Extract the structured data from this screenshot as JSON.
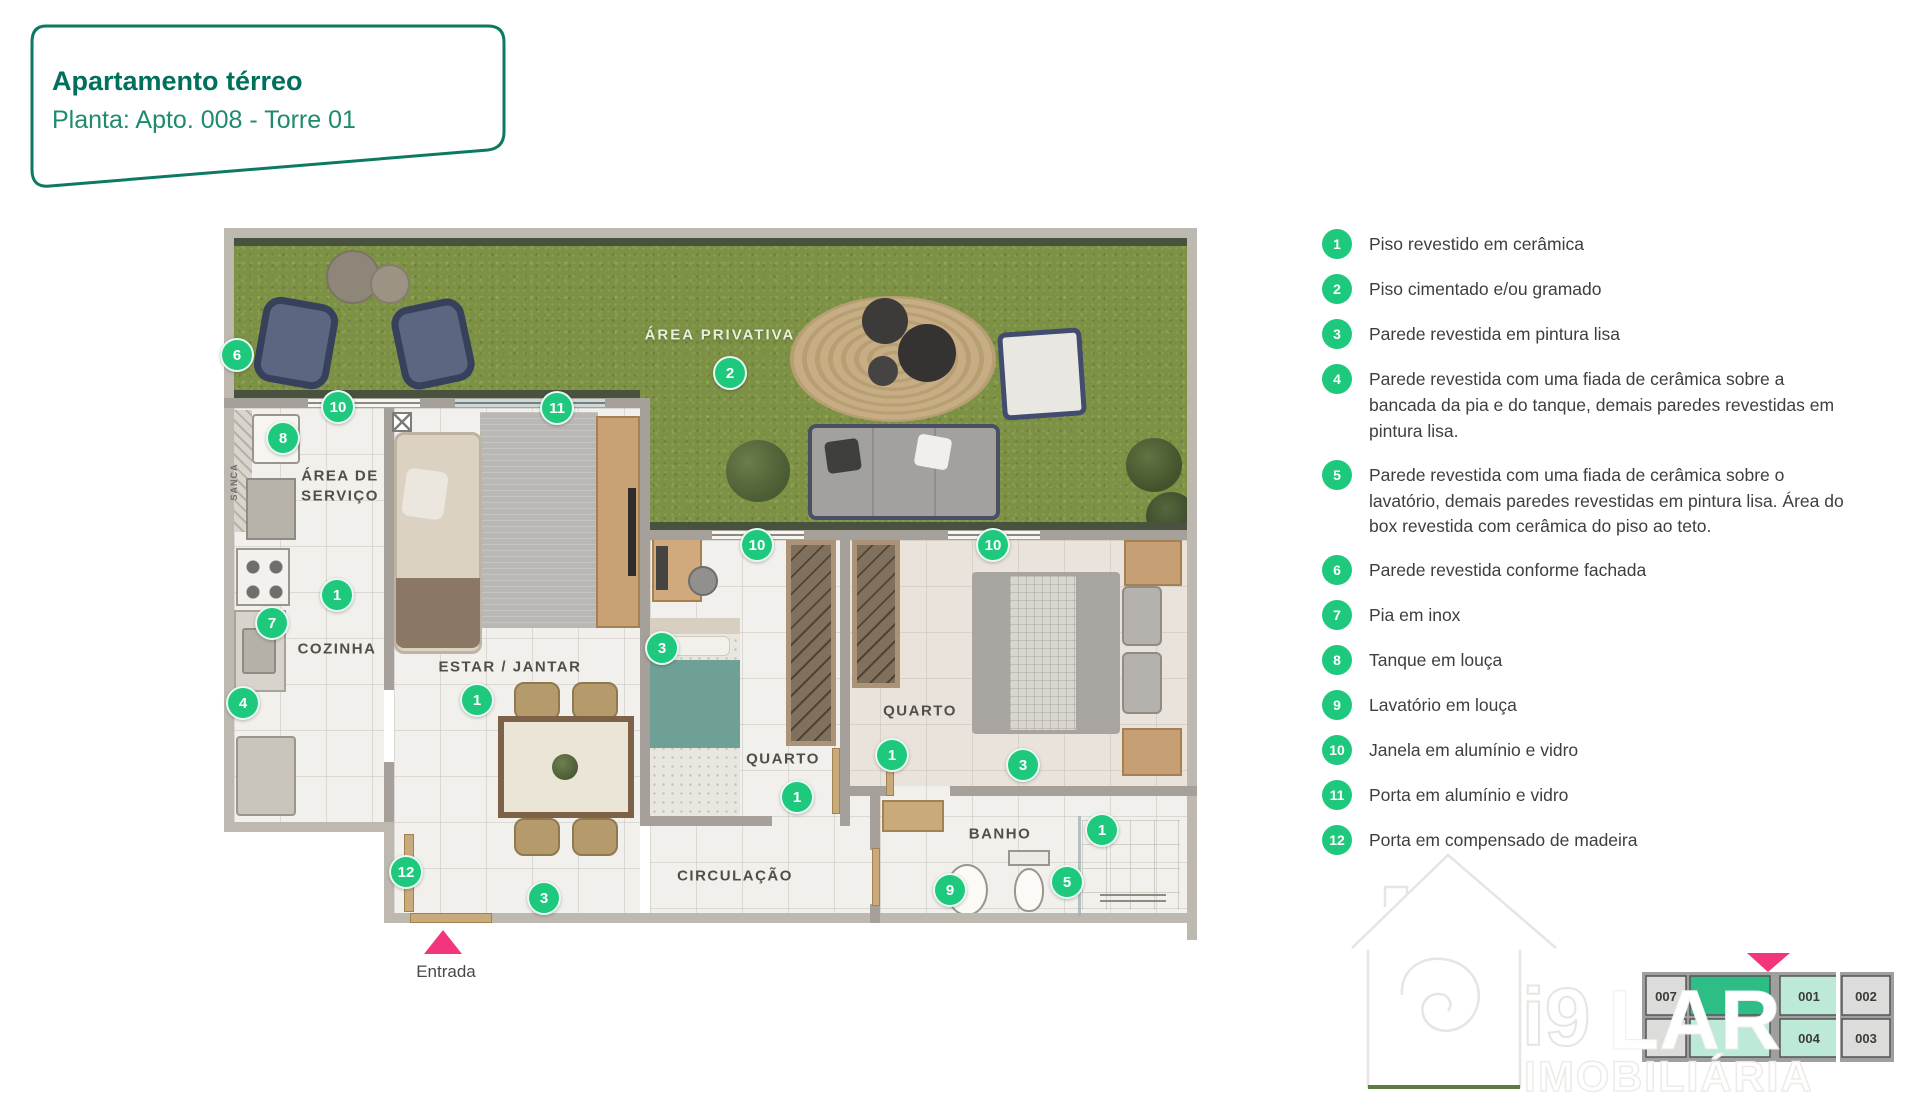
{
  "title": {
    "heading": "Apartamento térreo",
    "subheading": "Planta: Apto. 008 - Torre 01"
  },
  "plan": {
    "labels": {
      "area_privativa": "ÁREA PRIVATIVA",
      "area_servico_l1": "ÁREA DE",
      "area_servico_l2": "SERVIÇO",
      "cozinha": "COZINHA",
      "estar_jantar": "ESTAR / JANTAR",
      "quarto_1": "QUARTO",
      "quarto_2": "QUARTO",
      "banho": "BANHO",
      "circulacao": "CIRCULAÇÃO",
      "sanca": "SANCA",
      "entrada": "Entrada"
    },
    "markers": [
      {
        "n": "6"
      },
      {
        "n": "10"
      },
      {
        "n": "8"
      },
      {
        "n": "11"
      },
      {
        "n": "2"
      },
      {
        "n": "10"
      },
      {
        "n": "10"
      },
      {
        "n": "1"
      },
      {
        "n": "7"
      },
      {
        "n": "4"
      },
      {
        "n": "1"
      },
      {
        "n": "3"
      },
      {
        "n": "1"
      },
      {
        "n": "1"
      },
      {
        "n": "3"
      },
      {
        "n": "12"
      },
      {
        "n": "3"
      },
      {
        "n": "9"
      },
      {
        "n": "5"
      },
      {
        "n": "1"
      }
    ]
  },
  "legend": {
    "items": [
      {
        "num": "1",
        "text": "Piso revestido em cerâmica"
      },
      {
        "num": "2",
        "text": "Piso cimentado e/ou gramado"
      },
      {
        "num": "3",
        "text": "Parede revestida em pintura lisa"
      },
      {
        "num": "4",
        "text": "Parede revestida com uma fiada de cerâmica sobre a bancada da pia e do tanque, demais paredes revestidas em pintura lisa."
      },
      {
        "num": "5",
        "text": "Parede revestida com uma fiada de cerâmica sobre o lavatório, demais paredes revestidas em pintura lisa. Área do box revestida com cerâmica do piso ao teto."
      },
      {
        "num": "6",
        "text": "Parede revestida conforme fachada"
      },
      {
        "num": "7",
        "text": "Pia em inox"
      },
      {
        "num": "8",
        "text": "Tanque em louça"
      },
      {
        "num": "9",
        "text": "Lavatório em louça"
      },
      {
        "num": "10",
        "text": "Janela em alumínio e vidro"
      },
      {
        "num": "11",
        "text": "Porta em alumínio e vidro"
      },
      {
        "num": "12",
        "text": "Porta em compensado de madeira"
      }
    ]
  },
  "brand": {
    "i9": "i9",
    "lar": "LAR",
    "imobiliaria": "IMOBILIÁRIA",
    "keyplan": {
      "units": [
        {
          "label": "007"
        },
        {
          "label": ""
        },
        {
          "label": "001"
        },
        {
          "label": "002"
        },
        {
          "label": ""
        },
        {
          "label": ""
        },
        {
          "label": "004"
        },
        {
          "label": "003"
        }
      ]
    }
  },
  "colors": {
    "marker_green": "#1ec97e",
    "title_teal": "#00705c",
    "subtitle_teal": "#1e8a70",
    "entrada_pink": "#f2357c",
    "grass_green": "#7d9145",
    "keyplan_highlight": "#2ebd85",
    "keyplan_mint": "#bcead6"
  }
}
